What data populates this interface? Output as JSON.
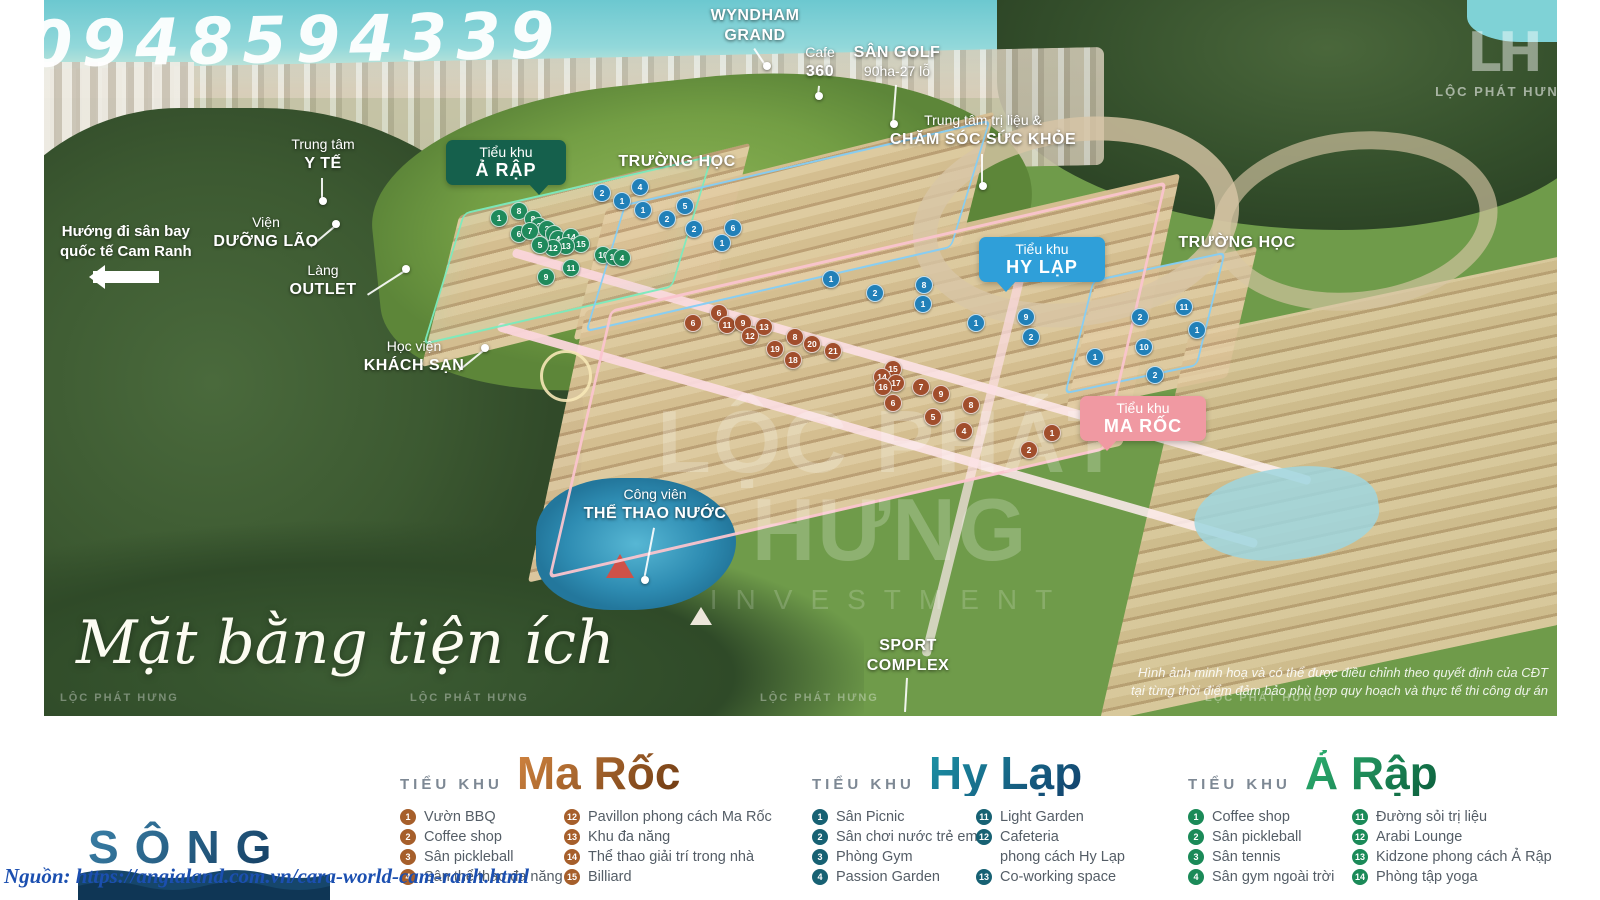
{
  "watermarks": {
    "phone": "0948594339",
    "brand": "LỘC PHÁT HƯNG",
    "brand_sub": "INVESTMENT",
    "logo_monogram": "LH",
    "logo_text": "LỘC PHÁT HƯNG",
    "small_repeat": "LỘC PHÁT HƯNG"
  },
  "map": {
    "script_title": "Mặt bằng tiện ích",
    "disclaimer_line1": "Hình ảnh minh hoạ và có thể được điều chỉnh theo quyết định của CĐT",
    "disclaimer_line2": "tại từng thời điểm đảm bảo phù hợp quy hoạch và thực tế thi công dự án",
    "direction": {
      "line1": "Hướng đi sân bay",
      "line2": "quốc tế Cam Ranh"
    },
    "labels": [
      {
        "id": "wyndham-grand",
        "x": 755,
        "y": 6,
        "lines": [
          [
            "WYNDHAM",
            true
          ],
          [
            "GRAND",
            true
          ]
        ],
        "dot": {
          "x": 767,
          "y": 66
        }
      },
      {
        "id": "cafe-360",
        "x": 820,
        "y": 44,
        "lines": [
          [
            "Cafe",
            false
          ],
          [
            "360",
            true
          ]
        ],
        "dot": {
          "x": 819,
          "y": 96
        }
      },
      {
        "id": "san-golf",
        "x": 897,
        "y": 43,
        "lines": [
          [
            "SÂN GOLF",
            true
          ],
          [
            "90ha-27 lỗ",
            false
          ]
        ],
        "dot": {
          "x": 894,
          "y": 124
        }
      },
      {
        "id": "cham-soc-suc-khoe",
        "x": 983,
        "y": 112,
        "lines": [
          [
            "Trung tâm trị liệu &",
            false
          ],
          [
            "CHĂM SÓC SỨC KHỎE",
            true
          ]
        ],
        "dot": {
          "x": 983,
          "y": 186
        }
      },
      {
        "id": "trung-tam-y-te",
        "x": 323,
        "y": 136,
        "lines": [
          [
            "Trung tâm",
            false
          ],
          [
            "Y TẾ",
            true
          ]
        ],
        "dot": {
          "x": 323,
          "y": 201
        }
      },
      {
        "id": "vien-duong-lao",
        "x": 266,
        "y": 214,
        "lines": [
          [
            "Viện",
            false
          ],
          [
            "DƯỠNG LÃO",
            true
          ]
        ],
        "dot": {
          "x": 336,
          "y": 224
        },
        "anchor": "right"
      },
      {
        "id": "lang-outlet",
        "x": 323,
        "y": 262,
        "lines": [
          [
            "Làng",
            false
          ],
          [
            "OUTLET",
            true
          ]
        ],
        "dot": {
          "x": 406,
          "y": 269
        },
        "anchor": "right"
      },
      {
        "id": "hoc-vien-khach-san",
        "x": 414,
        "y": 338,
        "lines": [
          [
            "Học viện",
            false
          ],
          [
            "KHÁCH SẠN",
            true
          ]
        ],
        "dot": {
          "x": 485,
          "y": 348
        },
        "anchor": "right"
      },
      {
        "id": "truong-hoc-1",
        "x": 677,
        "y": 152,
        "lines": [
          [
            "TRƯỜNG HỌC",
            true
          ]
        ]
      },
      {
        "id": "truong-hoc-2",
        "x": 1237,
        "y": 233,
        "lines": [
          [
            "TRƯỜNG HỌC",
            true
          ]
        ]
      },
      {
        "id": "cong-vien-the-thao-nuoc",
        "x": 655,
        "y": 486,
        "lines": [
          [
            "Công viên",
            false
          ],
          [
            "THỂ THAO NƯỚC",
            true
          ]
        ],
        "dot": {
          "x": 645,
          "y": 580
        }
      },
      {
        "id": "sport-complex",
        "x": 908,
        "y": 636,
        "lines": [
          [
            "SPORT",
            true
          ],
          [
            "COMPLEX",
            true
          ]
        ],
        "dot": {
          "x": 906,
          "y": 712
        },
        "nodot": true
      }
    ],
    "badges": [
      {
        "id": "a-rap",
        "line1": "Tiểu khu",
        "line2": "Ả RẬP",
        "x": 446,
        "y": 140,
        "w": 100,
        "color": "#15604c",
        "tail": "right"
      },
      {
        "id": "hy-lap",
        "line1": "Tiểu khu",
        "line2": "HY LẠP",
        "x": 979,
        "y": 237,
        "w": 106,
        "color": "#2f9fd9",
        "tail": "left"
      },
      {
        "id": "ma-roc",
        "line1": "Tiểu khu",
        "line2": "MA RỐC",
        "x": 1080,
        "y": 396,
        "w": 106,
        "color": "#f099a2",
        "tail": "left"
      }
    ],
    "markers": {
      "green": [
        [
          499,
          218,
          "1"
        ],
        [
          519,
          211,
          "8"
        ],
        [
          533,
          219,
          "8"
        ],
        [
          539,
          226,
          "2"
        ],
        [
          547,
          229,
          "3"
        ],
        [
          554,
          234,
          "2"
        ],
        [
          519,
          234,
          "6"
        ],
        [
          530,
          231,
          "7"
        ],
        [
          558,
          239,
          "4"
        ],
        [
          571,
          237,
          "14"
        ],
        [
          581,
          244,
          "15"
        ],
        [
          566,
          246,
          "13"
        ],
        [
          553,
          248,
          "12"
        ],
        [
          540,
          245,
          "5"
        ],
        [
          603,
          255,
          "10"
        ],
        [
          614,
          257,
          "11"
        ],
        [
          622,
          258,
          "4"
        ],
        [
          571,
          268,
          "11"
        ],
        [
          546,
          277,
          "9"
        ]
      ],
      "blue": [
        [
          602,
          193,
          "2"
        ],
        [
          640,
          187,
          "4"
        ],
        [
          622,
          201,
          "1"
        ],
        [
          643,
          210,
          "1"
        ],
        [
          667,
          219,
          "2"
        ],
        [
          685,
          206,
          "5"
        ],
        [
          694,
          229,
          "2"
        ],
        [
          733,
          228,
          "6"
        ],
        [
          722,
          243,
          "1"
        ],
        [
          831,
          279,
          "1"
        ],
        [
          875,
          293,
          "2"
        ],
        [
          924,
          285,
          "8"
        ],
        [
          923,
          304,
          "1"
        ],
        [
          976,
          323,
          "1"
        ],
        [
          1026,
          317,
          "9"
        ],
        [
          1031,
          337,
          "2"
        ],
        [
          1184,
          307,
          "11"
        ],
        [
          1140,
          317,
          "2"
        ],
        [
          1197,
          330,
          "1"
        ],
        [
          1144,
          347,
          "10"
        ],
        [
          1095,
          357,
          "1"
        ],
        [
          1155,
          375,
          "2"
        ]
      ],
      "brown": [
        [
          719,
          313,
          "6"
        ],
        [
          693,
          323,
          "6"
        ],
        [
          727,
          325,
          "11"
        ],
        [
          743,
          323,
          "9"
        ],
        [
          764,
          327,
          "13"
        ],
        [
          750,
          336,
          "12"
        ],
        [
          795,
          337,
          "8"
        ],
        [
          812,
          344,
          "20"
        ],
        [
          775,
          349,
          "19"
        ],
        [
          833,
          351,
          "21"
        ],
        [
          793,
          360,
          "18"
        ],
        [
          893,
          369,
          "15"
        ],
        [
          882,
          377,
          "14"
        ],
        [
          896,
          383,
          "17"
        ],
        [
          883,
          387,
          "16"
        ],
        [
          921,
          387,
          "7"
        ],
        [
          941,
          394,
          "9"
        ],
        [
          893,
          403,
          "6"
        ],
        [
          971,
          405,
          "8"
        ],
        [
          933,
          417,
          "5"
        ],
        [
          964,
          431,
          "4"
        ],
        [
          1052,
          433,
          "1"
        ],
        [
          1029,
          450,
          "2"
        ]
      ]
    }
  },
  "legend": {
    "sections": [
      {
        "id": "ma-roc",
        "left": 400,
        "kicker": "TIỂU KHU",
        "name": "Ma Rốc",
        "grad_from": "#d08440",
        "grad_to": "#6e3a12",
        "marker": "#a65f2b",
        "col1": [
          [
            "1",
            "Vườn BBQ"
          ],
          [
            "2",
            "Coffee shop"
          ],
          [
            "3",
            "Sân pickleball"
          ],
          [
            "4",
            "Sân thể thao đa năng"
          ]
        ],
        "col2": [
          [
            "12",
            "Pavillon phong cách Ma Rốc"
          ],
          [
            "13",
            "Khu đa năng"
          ],
          [
            "14",
            "Thể thao giải trí trong nhà"
          ],
          [
            "15",
            "Billiard"
          ]
        ]
      },
      {
        "id": "hy-lap",
        "left": 812,
        "kicker": "TIỂU KHU",
        "name": "Hy Lạp",
        "grad_from": "#1b93a6",
        "grad_to": "#123f6b",
        "marker": "#176173",
        "col1": [
          [
            "1",
            "Sân Picnic"
          ],
          [
            "2",
            "Sân chơi nước trẻ em"
          ],
          [
            "3",
            "Phòng Gym"
          ],
          [
            "4",
            "Passion Garden"
          ]
        ],
        "col2": [
          [
            "11",
            "Light Garden"
          ],
          [
            "12",
            "Cafeteria"
          ],
          [
            "",
            "phong cách Hy Lạp"
          ],
          [
            "13",
            "Co-working space"
          ]
        ]
      },
      {
        "id": "a-rap",
        "left": 1188,
        "kicker": "TIỂU KHU",
        "name": "Ả Rập",
        "grad_from": "#2eb271",
        "grad_to": "#0b5e3c",
        "marker": "#1b8a58",
        "col1": [
          [
            "1",
            "Coffee shop"
          ],
          [
            "2",
            "Sân pickleball"
          ],
          [
            "3",
            "Sân tennis"
          ],
          [
            "4",
            "Sân gym ngoài trời"
          ]
        ],
        "col2": [
          [
            "11",
            "Đường sỏi trị liệu"
          ],
          [
            "12",
            "Arabi Lounge"
          ],
          [
            "13",
            "Kidzone phong cách Ả Rập"
          ],
          [
            "14",
            "Phòng tập yoga"
          ]
        ]
      }
    ]
  },
  "footer": {
    "song": "SÔNG",
    "source": "Nguồn: https://angialand.com.vn/cara-world-cam-ranh.html"
  }
}
